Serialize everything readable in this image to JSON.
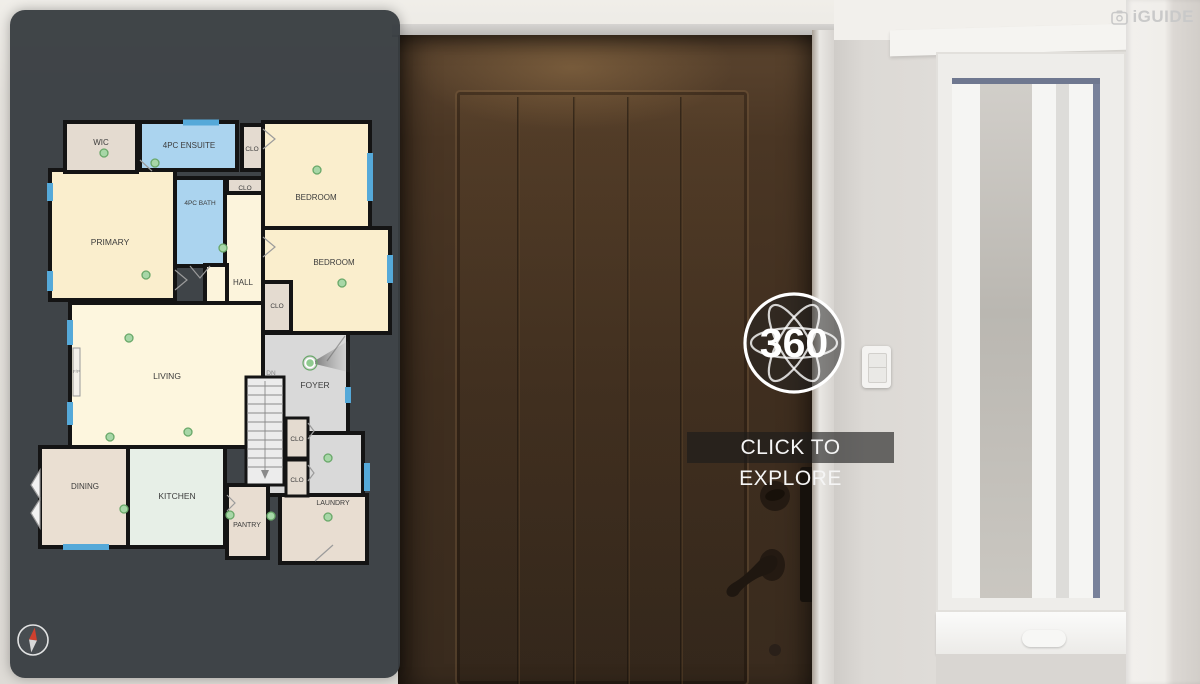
{
  "header": {
    "logo_text": "iGUIDE"
  },
  "viewer": {
    "badge_label": "360",
    "cta_label": "CLICK TO EXPLORE"
  },
  "floorplan": {
    "labels": {
      "wic": "WIC",
      "ensuite": "4PC ENSUITE",
      "bath": "4PC BATH",
      "clo": "CLO",
      "bedroom": "BEDROOM",
      "primary": "PRIMARY",
      "hall": "HALL",
      "living": "LIVING",
      "foyer": "FOYER",
      "dn": "DN",
      "dining": "DINING",
      "kitchen": "KITCHEN",
      "pantry": "PANTRY",
      "laundry": "LAUNDRY",
      "fireplace": "F/P"
    },
    "colors": {
      "panel_bg": "#383d42",
      "wall": "#141414",
      "window": "#55a9d9",
      "room_cream": "#faeecd",
      "room_pale": "#fdf6de",
      "closet_beige": "#e4dbd0",
      "bath_blue": "#abd4ef",
      "kitchen_mint": "#e7efe7",
      "foyer_gray": "#d9d9d9",
      "dining_beige": "#eadfd2",
      "camera_dot": "#a7d7a7",
      "camera_dot_ring": "#69a869"
    },
    "camera_count": 15
  },
  "compass": {
    "needle_north": "#d0402e",
    "needle_south": "#dadada"
  }
}
